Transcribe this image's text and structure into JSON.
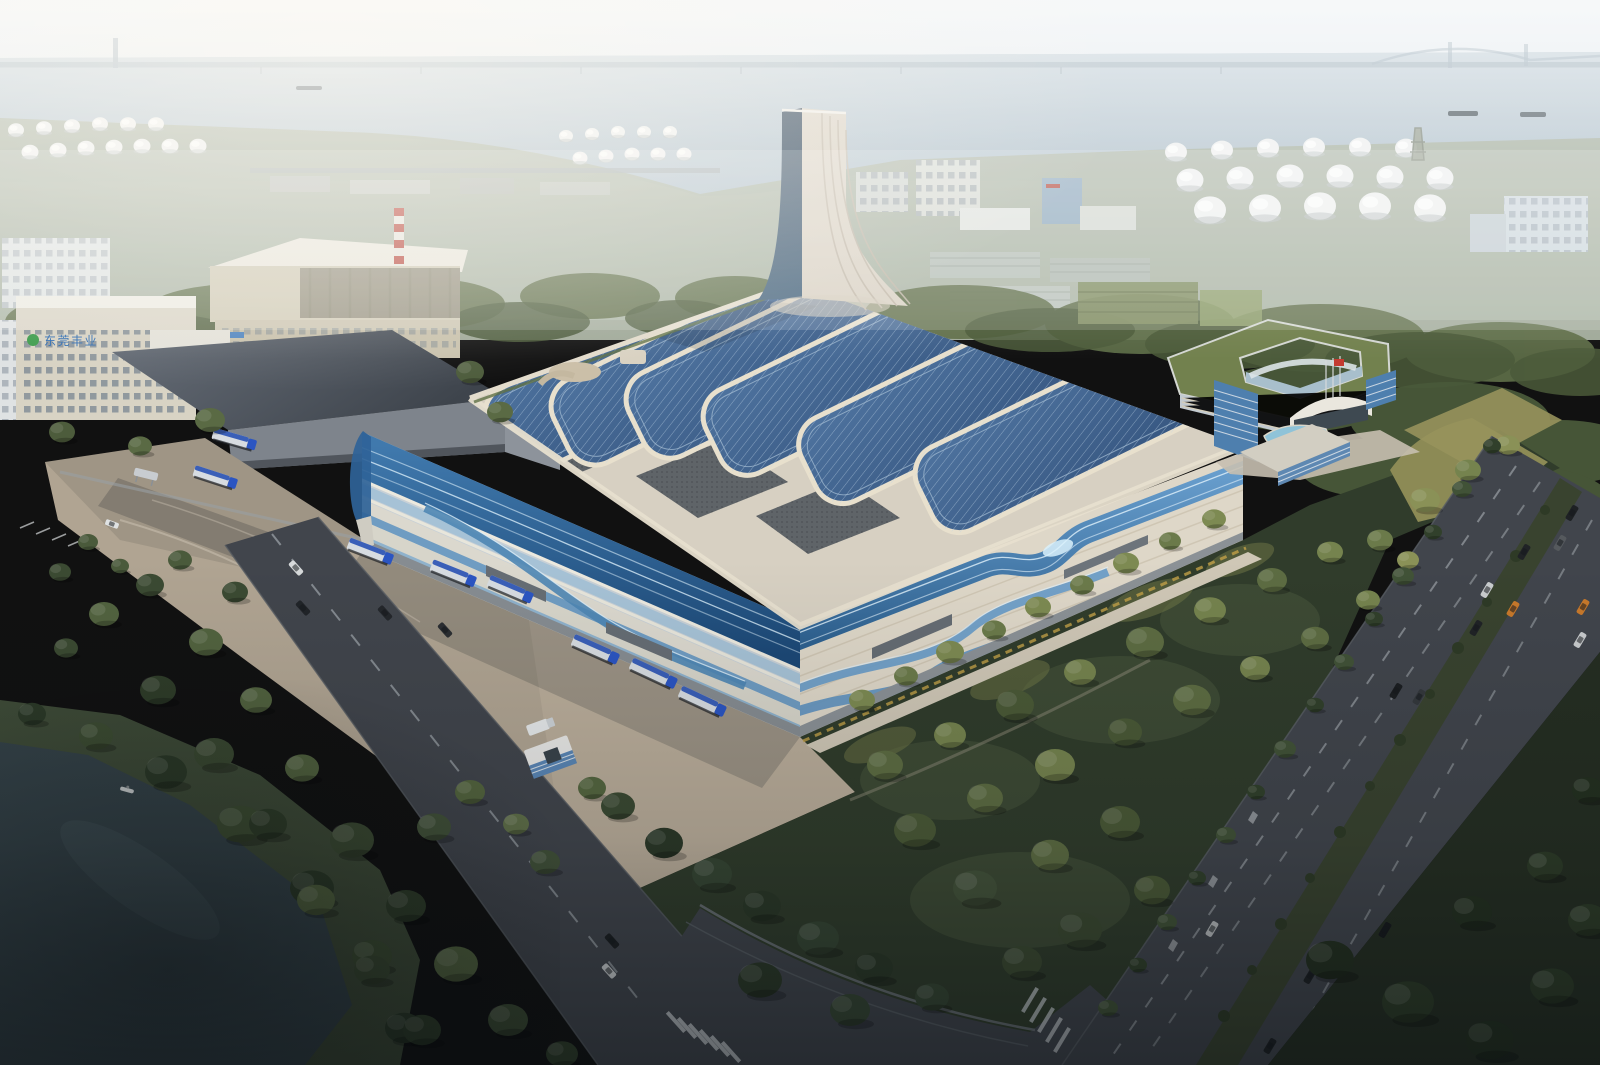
{
  "scene": {
    "type": "aerial-architectural-rendering",
    "subject": "riverside industrial plant with wave-form facade, rooftop solar arrays and sculptural stack",
    "signage": {
      "factory_sign": "东莞丰业"
    },
    "flag": {
      "color_hex": "#c43b30"
    },
    "palette": {
      "sky": "#dde7ec",
      "water": "#b6c5cf",
      "roof_cream": "#d7d0c2",
      "solar_blue": "#42628c",
      "facade_blue": "#2f6398",
      "facade_cream": "#ded7c8",
      "plaza": "#b0a492",
      "road": "#41454c",
      "park_green": "#303c2b",
      "pond_water": "#36444a",
      "tree_green": "#55663f",
      "truck_blue": "#2b55c2",
      "sign_blue": "#2f6db3",
      "tank_white": "#eef0ef"
    }
  }
}
